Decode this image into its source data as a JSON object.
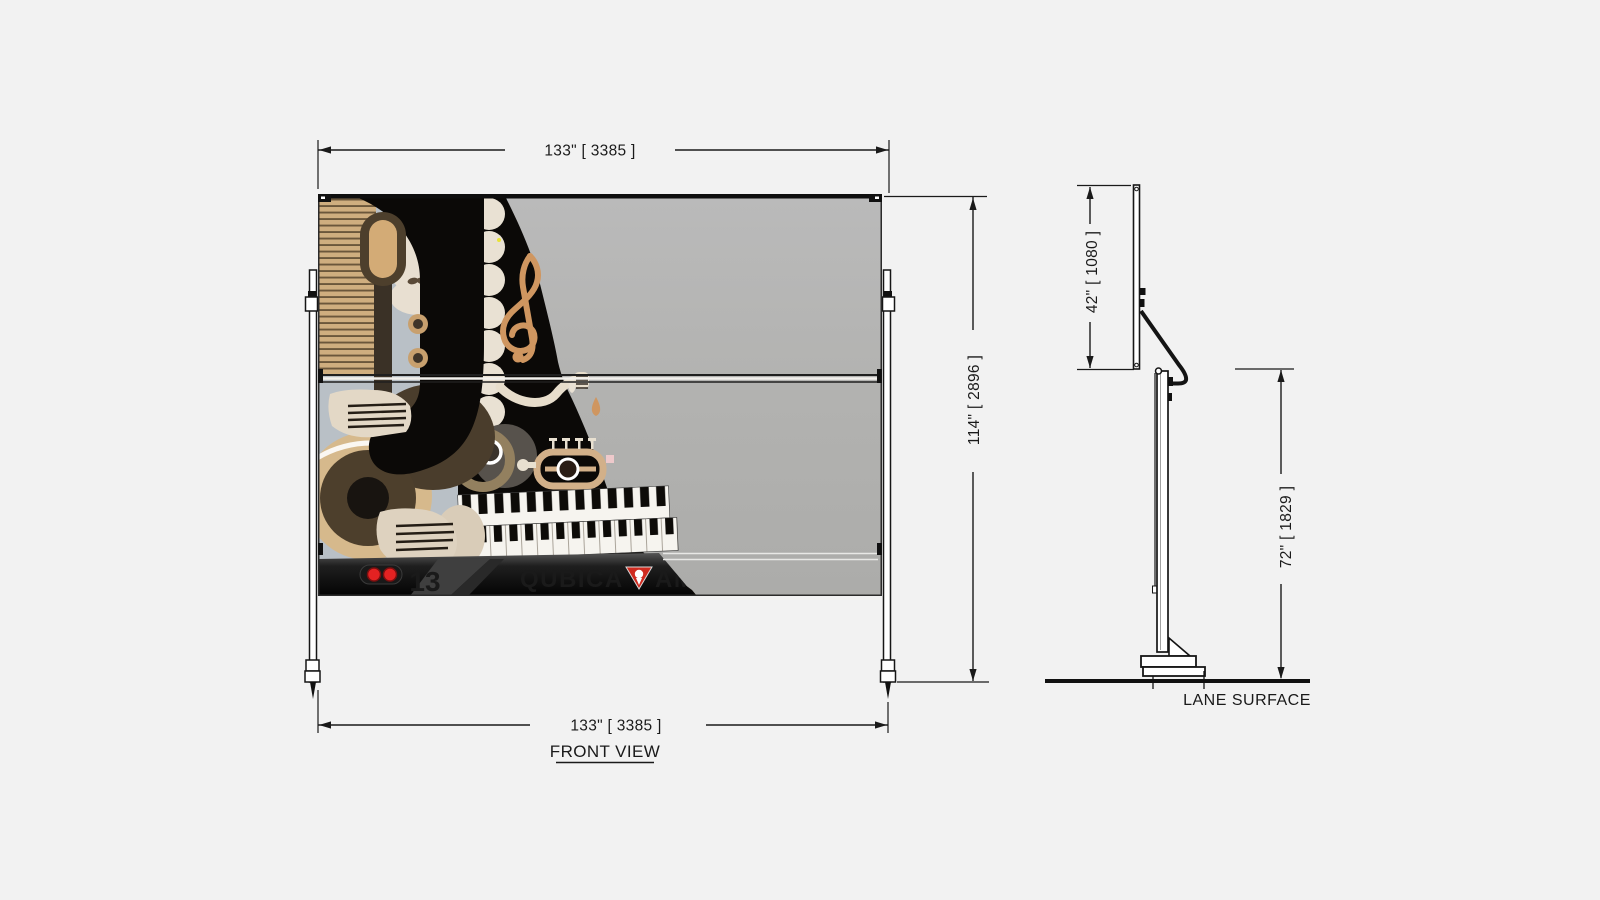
{
  "drawing": {
    "front_view": {
      "label": "FRONT VIEW",
      "dim_top": "133\" [ 3385 ]",
      "dim_bottom": "133\" [ 3385 ]",
      "dim_height": "114\" [ 2896 ]",
      "lane_number": "13",
      "indicator_dots": 2,
      "brand_left": "QUBICA",
      "brand_right": "AM"
    },
    "side_view": {
      "dim_panel_height": "42\" [ 1080 ]",
      "dim_stand_height": "72\" [ 1829 ]",
      "floor_label": "LANE SURFACE"
    },
    "icons": {
      "logo_mark": "amf-pin-triangle-icon",
      "artwork_theme": "abstract-jazz-musician-piano-mural"
    },
    "colors": {
      "canvas_bg": "#f2f2f2",
      "panel_gray": "#b4b4b2",
      "artwork_black": "#0b0907",
      "artwork_bluegray": "#b9c0c6",
      "artwork_tan": "#cfae7f",
      "artwork_dark_brown": "#4d3f2c",
      "artwork_cream": "#e8dfd1",
      "clef_copper": "#cf9660",
      "indicator_red": "#e32222",
      "brand_gray": "#b9b9b9",
      "logo_red": "#cf2b20",
      "line_ink": "#1a1a1a"
    }
  }
}
